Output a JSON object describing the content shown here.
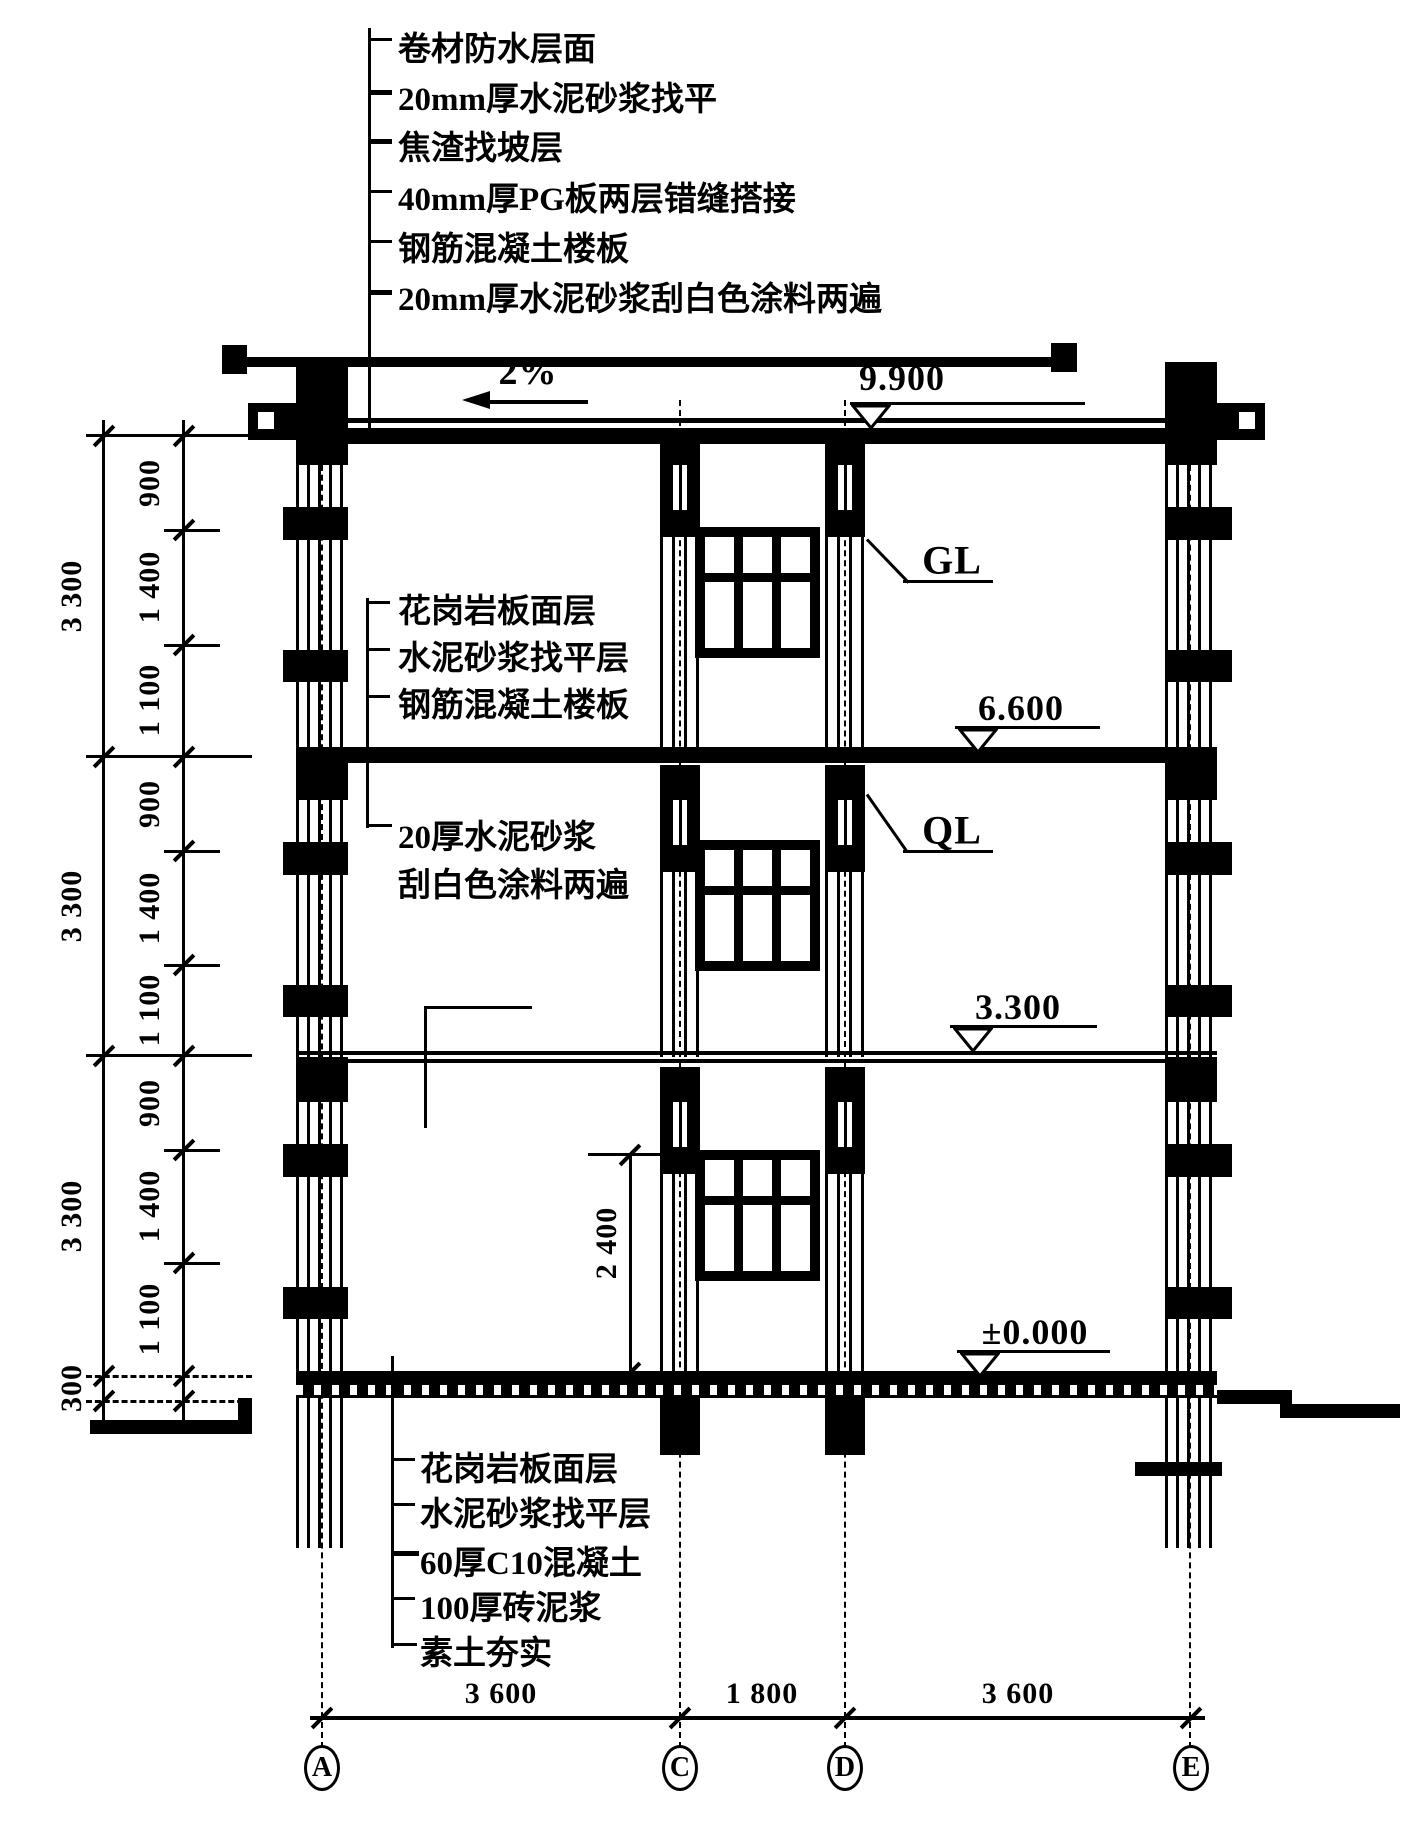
{
  "drawing_title": "墙身剖面详图 (wall section detail)",
  "roof_layers": [
    "卷材防水层面",
    "20mm厚水泥砂浆找平",
    "焦渣找坡层",
    "40mm厚PG板两层错缝搭接",
    "钢筋混凝土楼板",
    "20mm厚水泥砂浆刮白色涂料两遍"
  ],
  "floor_layers": [
    "花岗岩板面层",
    "水泥砂浆找平层",
    "钢筋混凝土楼板"
  ],
  "wall_finish": [
    "20厚水泥砂浆",
    "刮白色涂料两遍"
  ],
  "ground_layers": [
    "花岗岩板面层",
    "水泥砂浆找平层",
    "60厚C10混凝土",
    "100厚砖泥浆",
    "素土夯实"
  ],
  "elevations": [
    "9.900",
    "6.600",
    "3.300",
    "±0.000"
  ],
  "slope_label": "2%",
  "beam_labels": {
    "gl": "GL",
    "ql": "QL"
  },
  "dims": {
    "left_overall": [
      "3 300",
      "3 300",
      "3 300"
    ],
    "base": "300",
    "left_segments": [
      "900",
      "1 400",
      "1 100",
      "900",
      "1 400",
      "1 100",
      "900",
      "1 400",
      "1 100"
    ],
    "window_height": "2 400",
    "bottom": [
      "3 600",
      "1 800",
      "3 600"
    ]
  },
  "grid_labels": [
    "A",
    "C",
    "D",
    "E"
  ],
  "colors": {
    "ink": "#000000",
    "paper": "#ffffff"
  }
}
